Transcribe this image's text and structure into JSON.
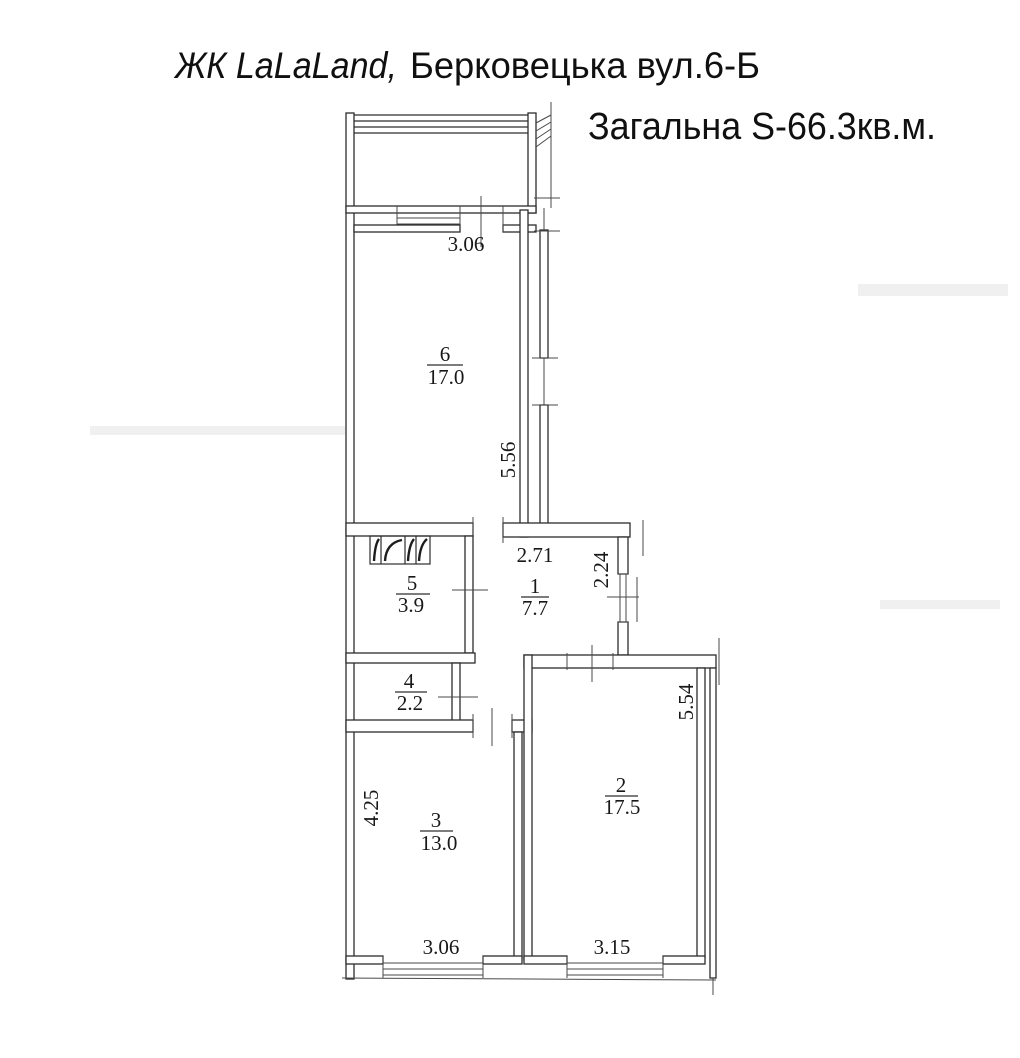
{
  "header": {
    "project": "ЖК LaLaLand,",
    "address": "Берковецька вул.6-Б",
    "total_area": "Загальна S-66.3кв.м."
  },
  "rooms": {
    "r6": {
      "number": "6",
      "area": "17.0"
    },
    "r5": {
      "number": "5",
      "area": "3.9"
    },
    "r1": {
      "number": "1",
      "area": "7.7"
    },
    "r4": {
      "number": "4",
      "area": "2.2"
    },
    "r3": {
      "number": "3",
      "area": "13.0"
    },
    "r2": {
      "number": "2",
      "area": "17.5"
    }
  },
  "dimensions": {
    "room6_width": "3.06",
    "room6_depth": "5.56",
    "hall_width": "2.71",
    "hall_depth": "2.24",
    "room3_depth": "4.25",
    "room3_width": "3.06",
    "room2_width": "3.15",
    "room2_depth": "5.54"
  }
}
